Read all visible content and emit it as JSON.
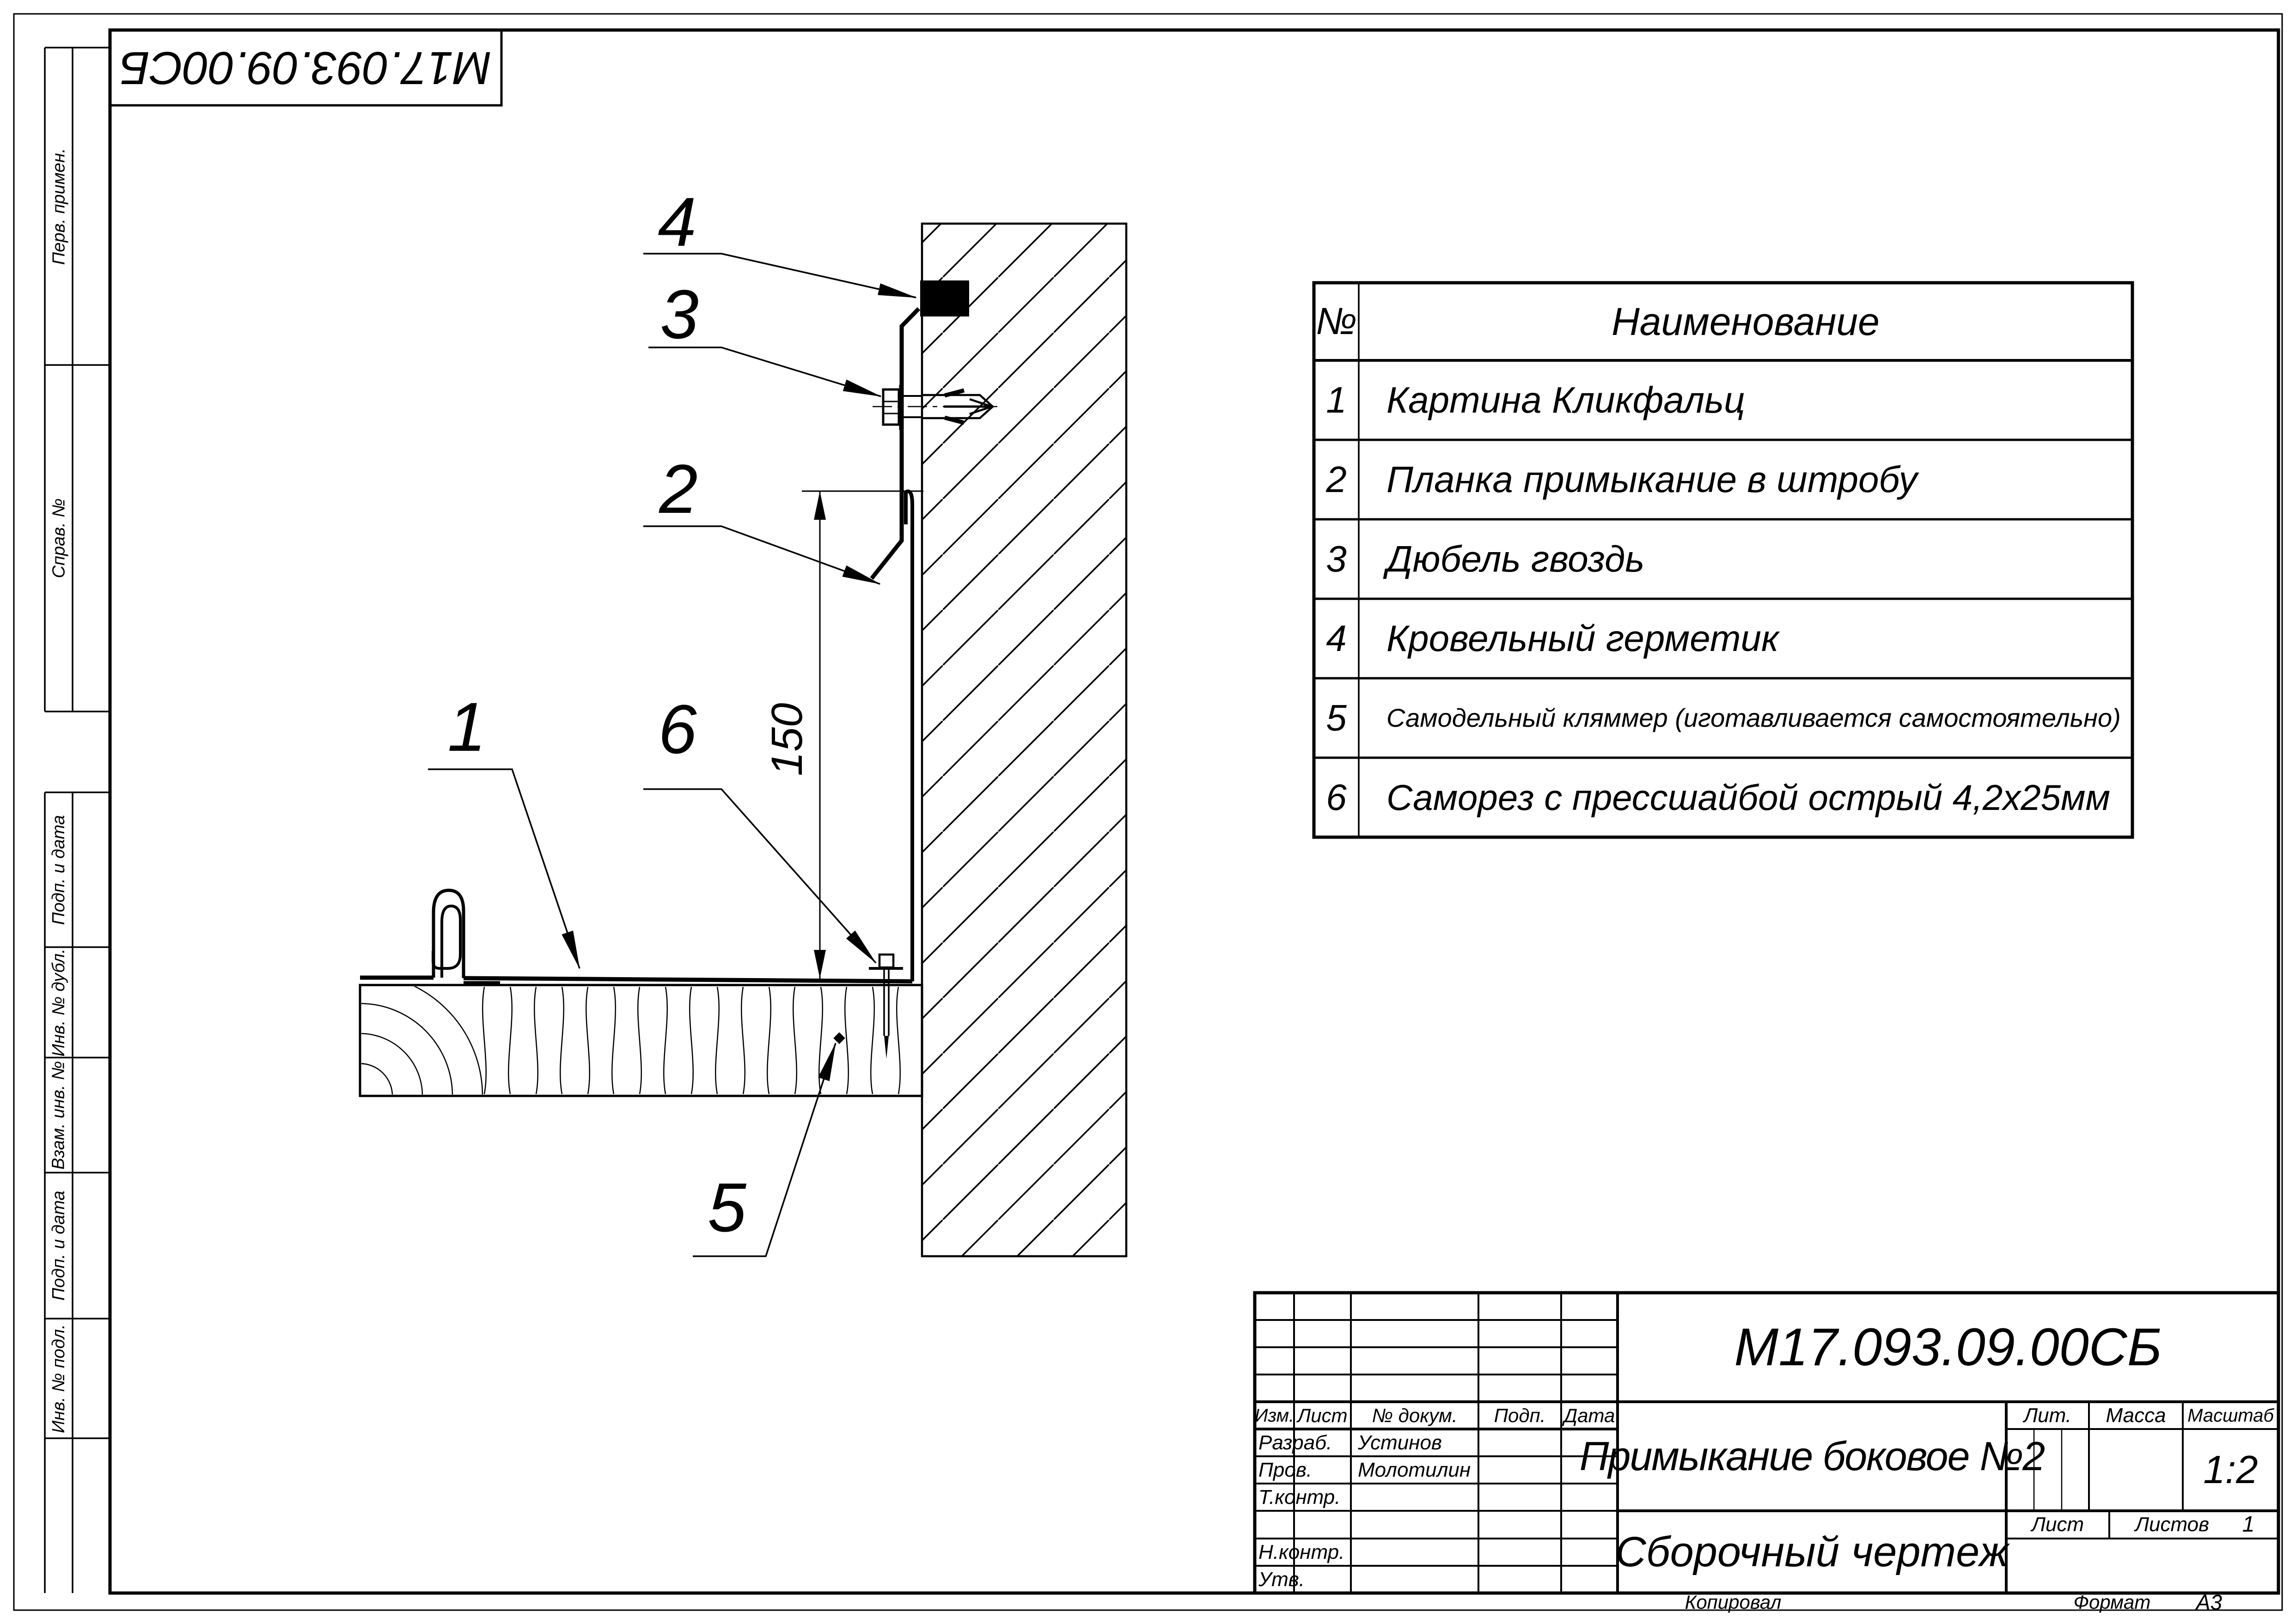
{
  "stamp": {
    "code": "М17.093.09.00СБ"
  },
  "margin_labels": [
    "Перв. примен.",
    "Справ. №",
    "Подп. и дата",
    "Инв. № дубл.",
    "Взам. инв. №",
    "Подп. и дата",
    "Инв. № подл."
  ],
  "parts_table": {
    "col_num": "№",
    "col_name": "Наименование",
    "rows": [
      {
        "num": "1",
        "name": "Картина Кликфальц"
      },
      {
        "num": "2",
        "name": "Планка примыкание в штробу"
      },
      {
        "num": "3",
        "name": "Дюбель гвоздь"
      },
      {
        "num": "4",
        "name": "Кровельный герметик"
      },
      {
        "num": "5",
        "name": "Самодельный кляммер (иготавливается самостоятельно)"
      },
      {
        "num": "6",
        "name": "Саморез с прессшайбой острый 4,2х25мм"
      }
    ]
  },
  "drawing": {
    "callouts": [
      "1",
      "2",
      "3",
      "4",
      "5",
      "6"
    ],
    "dimension": "150"
  },
  "title_block": {
    "doc_number": "М17.093.09.00СБ",
    "title": "Примыкание боковое №2",
    "doc_type": "Сборочный чертеж",
    "col_izm": "Изм.",
    "col_list": "Лист",
    "col_dokum": "№ докум.",
    "col_podp": "Подп.",
    "col_data": "Дата",
    "row_razrab": "Разраб.",
    "row_prov": "Пров.",
    "row_tkontr": "Т.контр.",
    "row_nkontr": "Н.контр.",
    "row_utv": "Утв.",
    "name_razrab": "Устинов",
    "name_prov": "Молотилин",
    "lit_label": "Лит.",
    "mass_label": "Масса",
    "scale_label": "Масштаб",
    "scale_value": "1:2",
    "sheet_label": "Лист",
    "sheets_label": "Листов",
    "sheets_value": "1",
    "kopiroval": "Копировал",
    "format_label": "Формат",
    "format_value": "А3"
  }
}
